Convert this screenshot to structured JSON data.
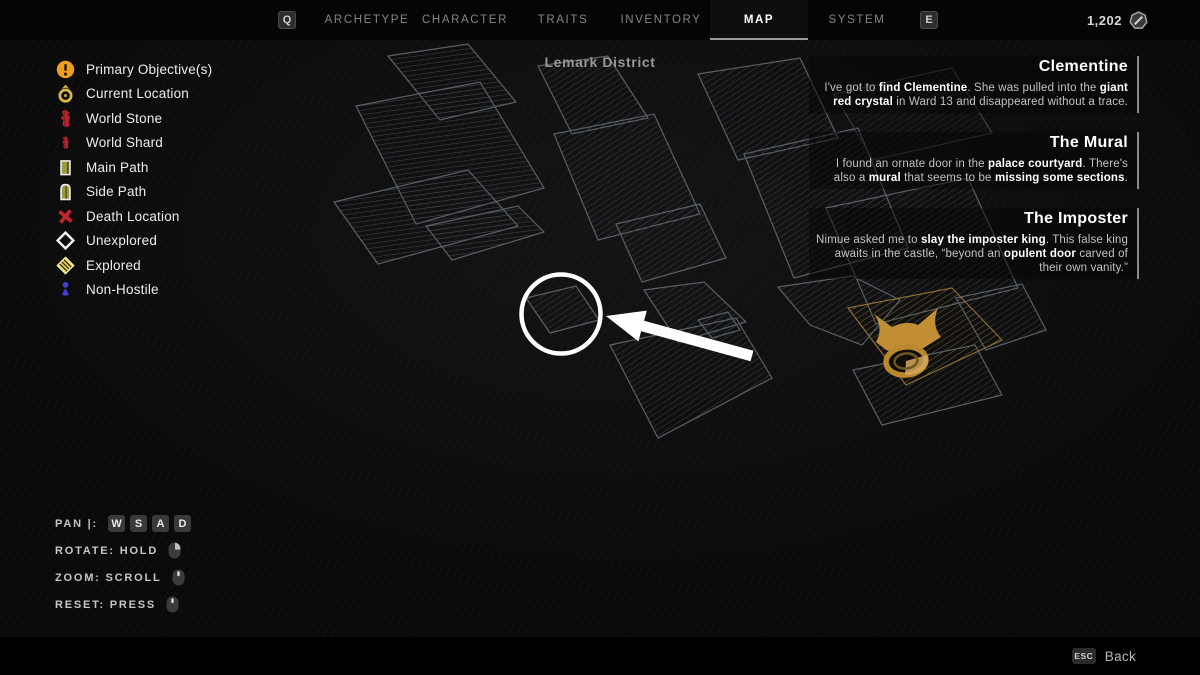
{
  "topbar": {
    "left_key": "Q",
    "right_key": "E",
    "tabs": [
      {
        "label": "ARCHETYPE"
      },
      {
        "label": "CHARACTER"
      },
      {
        "label": "TRAITS"
      },
      {
        "label": "INVENTORY"
      },
      {
        "label": "MAP"
      },
      {
        "label": "SYSTEM"
      }
    ],
    "active_tab": "MAP",
    "currency": {
      "amount": "1,202",
      "icon": "scrap-coin-icon"
    }
  },
  "map": {
    "title": "Lemark District"
  },
  "legend": {
    "items": [
      {
        "icon": "primary-objective-icon",
        "label": "Primary Objective(s)"
      },
      {
        "icon": "current-location-icon",
        "label": "Current Location"
      },
      {
        "icon": "world-stone-icon",
        "label": "World Stone"
      },
      {
        "icon": "world-shard-icon",
        "label": "World Shard"
      },
      {
        "icon": "main-path-icon",
        "label": "Main Path"
      },
      {
        "icon": "side-path-icon",
        "label": "Side Path"
      },
      {
        "icon": "death-location-icon",
        "label": "Death Location"
      },
      {
        "icon": "unexplored-icon",
        "label": "Unexplored"
      },
      {
        "icon": "explored-icon",
        "label": "Explored"
      },
      {
        "icon": "non-hostile-icon",
        "label": "Non-Hostile"
      }
    ]
  },
  "quests": [
    {
      "title": "Clementine",
      "body": [
        {
          "t": "I've got to ",
          "b": false
        },
        {
          "t": "find Clementine",
          "b": true
        },
        {
          "t": ". She was pulled into the ",
          "b": false
        },
        {
          "t": "giant red crystal",
          "b": true
        },
        {
          "t": " in Ward 13 and disappeared without a trace.",
          "b": false
        }
      ]
    },
    {
      "title": "The Mural",
      "body": [
        {
          "t": "I found an ornate door in the ",
          "b": false
        },
        {
          "t": "palace courtyard",
          "b": true
        },
        {
          "t": ". There's also a ",
          "b": false
        },
        {
          "t": "mural",
          "b": true
        },
        {
          "t": " that seems to be ",
          "b": false
        },
        {
          "t": "missing some sections",
          "b": true
        },
        {
          "t": ".",
          "b": false
        }
      ]
    },
    {
      "title": "The Imposter",
      "body": [
        {
          "t": "Nimue asked me to ",
          "b": false
        },
        {
          "t": "slay the imposter king",
          "b": true
        },
        {
          "t": ". This false king awaits in the castle, “beyond an ",
          "b": false
        },
        {
          "t": "opulent door",
          "b": true
        },
        {
          "t": " carved of their own vanity.”",
          "b": false
        }
      ]
    }
  ],
  "controls": {
    "pan": {
      "label": "PAN |:",
      "keys": [
        "W",
        "S",
        "A",
        "D"
      ]
    },
    "rotate": {
      "label": "ROTATE: HOLD",
      "icon": "mouse-right-button-icon"
    },
    "zoom": {
      "label": "ZOOM: SCROLL",
      "icon": "mouse-wheel-icon"
    },
    "reset": {
      "label": "RESET: PRESS",
      "icon": "mouse-wheel-icon"
    }
  },
  "footer": {
    "key": "ESC",
    "label": "Back"
  },
  "colors": {
    "accent_gold": "#C28E35",
    "objective_orange": "#ED9E1F",
    "stone_red": "#B5242E",
    "path_olive": "#9A9A40",
    "death_red": "#C4252C",
    "explored_yellow": "#E8D94B",
    "nonhostile_blue": "#4040D8"
  }
}
